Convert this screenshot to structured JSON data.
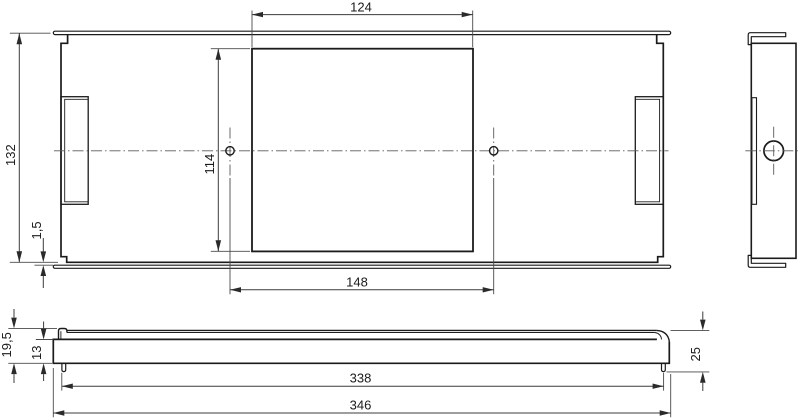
{
  "drawing": {
    "background": "#ffffff",
    "line_color": "#1b1b1b",
    "dimensions": {
      "front_view": {
        "opening_width": "124",
        "overall_height": "132",
        "opening_height": "114",
        "hole_spacing": "148",
        "bottom_edge_offset": "1,5"
      },
      "bottom_view": {
        "total_profile_height": "19,5",
        "body_profile_height": "13",
        "inner_length": "338",
        "overall_length": "346"
      },
      "side_view": {
        "depth": "25"
      }
    }
  }
}
